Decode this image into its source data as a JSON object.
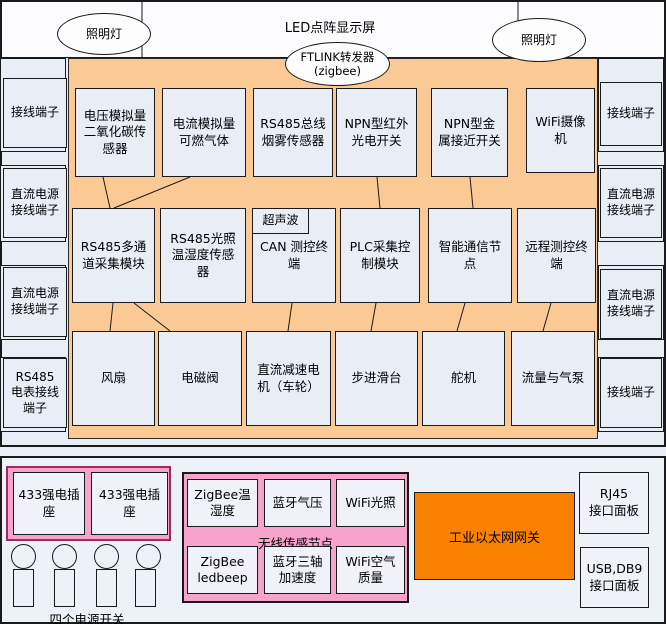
{
  "top": {
    "title": "LED点阵显示屏",
    "lamp_left": "照明灯",
    "lamp_right": "照明灯",
    "ftlink_line1": "FTLINK转发器",
    "ftlink_line2": "(zigbee)"
  },
  "left_column": {
    "items": [
      "接线端子",
      "直流电源接线端子",
      "直流电源接线端子",
      "RS485电表接线端子"
    ]
  },
  "right_column": {
    "items": [
      "接线端子",
      "直流电源接线端子",
      "直流电源接线端子",
      "接线端子"
    ]
  },
  "grid": {
    "row1": [
      "电压模拟量二氧化碳传感器",
      "电流模拟量可燃气体",
      "RS485总线烟雾传感器",
      "NPN型红外光电开关",
      "NPN型金属接近开关",
      "WiFi摄像机"
    ],
    "row2": [
      "RS485多通道采集模块",
      "RS485光照温湿度传感器",
      "CAN 测控终端",
      "PLC采集控制模块",
      "智能通信节点",
      "远程测控终端"
    ],
    "ultrasonic": "超声波",
    "row3": [
      "风扇",
      "电磁阀",
      "直流减速电机（车轮）",
      "步进滑台",
      "舵机",
      "流量与气泵"
    ]
  },
  "connections": [
    {
      "from": "电压模拟量二氧化碳传感器",
      "to": "RS485多通道采集模块"
    },
    {
      "from": "电流模拟量可燃气体",
      "to": "RS485多通道采集模块"
    },
    {
      "from": "NPN型红外光电开关",
      "to": "PLC采集控制模块"
    },
    {
      "from": "NPN型金属接近开关",
      "to": "智能通信节点"
    },
    {
      "from": "RS485多通道采集模块",
      "to": "风扇"
    },
    {
      "from": "RS485多通道采集模块",
      "to": "电磁阀"
    },
    {
      "from": "CAN测控终端",
      "to": "直流减速电机（车轮）"
    },
    {
      "from": "PLC采集控制模块",
      "to": "步进滑台"
    },
    {
      "from": "智能通信节点",
      "to": "舵机"
    },
    {
      "from": "远程测控终端",
      "to": "流量与气泵"
    }
  ],
  "bottom": {
    "socket1": "433强电插座",
    "socket2": "433强电插座",
    "switch_label": "四个电源开关",
    "switch_count": 4,
    "wireless": {
      "label": "无线传感节点",
      "nodes": [
        "ZigBee温湿度",
        "蓝牙气压",
        "WiFi光照",
        "ZigBee ledbeep",
        "蓝牙三轴加速度",
        "WiFi空气质量"
      ]
    },
    "gateway": "工业以太网网关",
    "rj45_line1": "RJ45",
    "rj45_line2": "接口面板",
    "usb_line1": "USB,DB9",
    "usb_line2": "接口面板"
  },
  "colors": {
    "panel_orange": "#FBCA94",
    "gateway_orange": "#F88100",
    "pink_fill": "#F7A3CB",
    "socket_border": "#9C2A5F",
    "box_fill": "#E9EDF6",
    "line": "#1A1A1A"
  }
}
